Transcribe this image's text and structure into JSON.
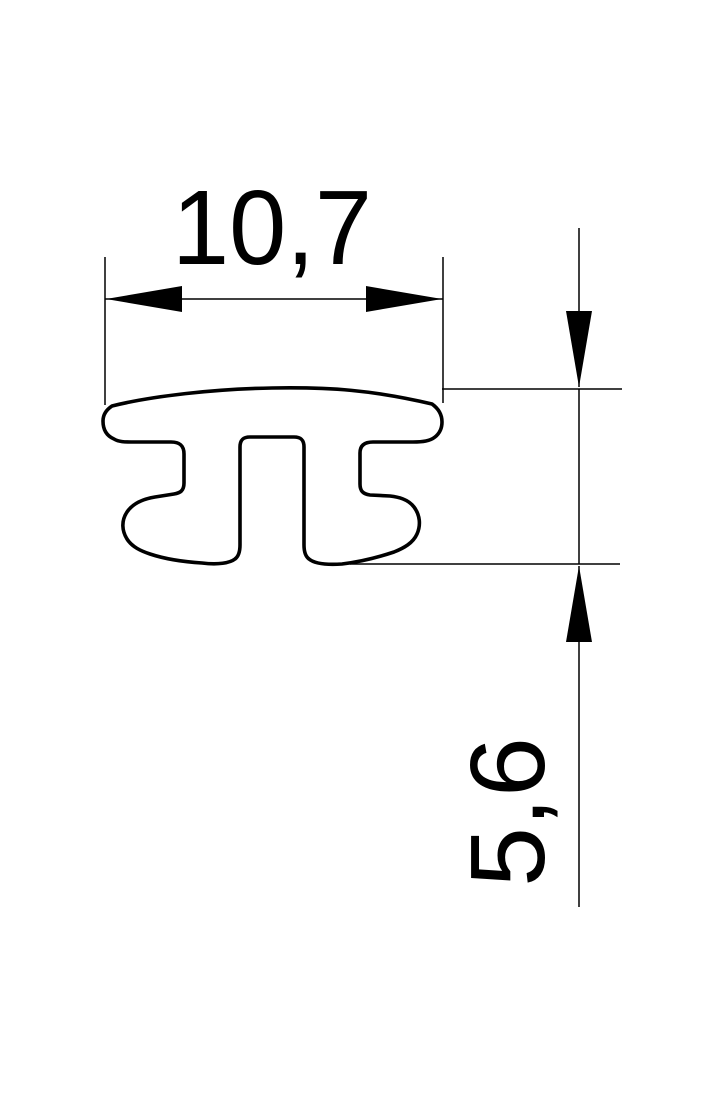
{
  "figure": {
    "kind": "technical-dimension-drawing",
    "subject": "h-profile-extrusion-cross-section"
  },
  "dimensions": {
    "width": {
      "label": "10,7"
    },
    "height": {
      "label": "5,6"
    }
  },
  "colors": {
    "ink": "#000000",
    "background": "#ffffff"
  }
}
